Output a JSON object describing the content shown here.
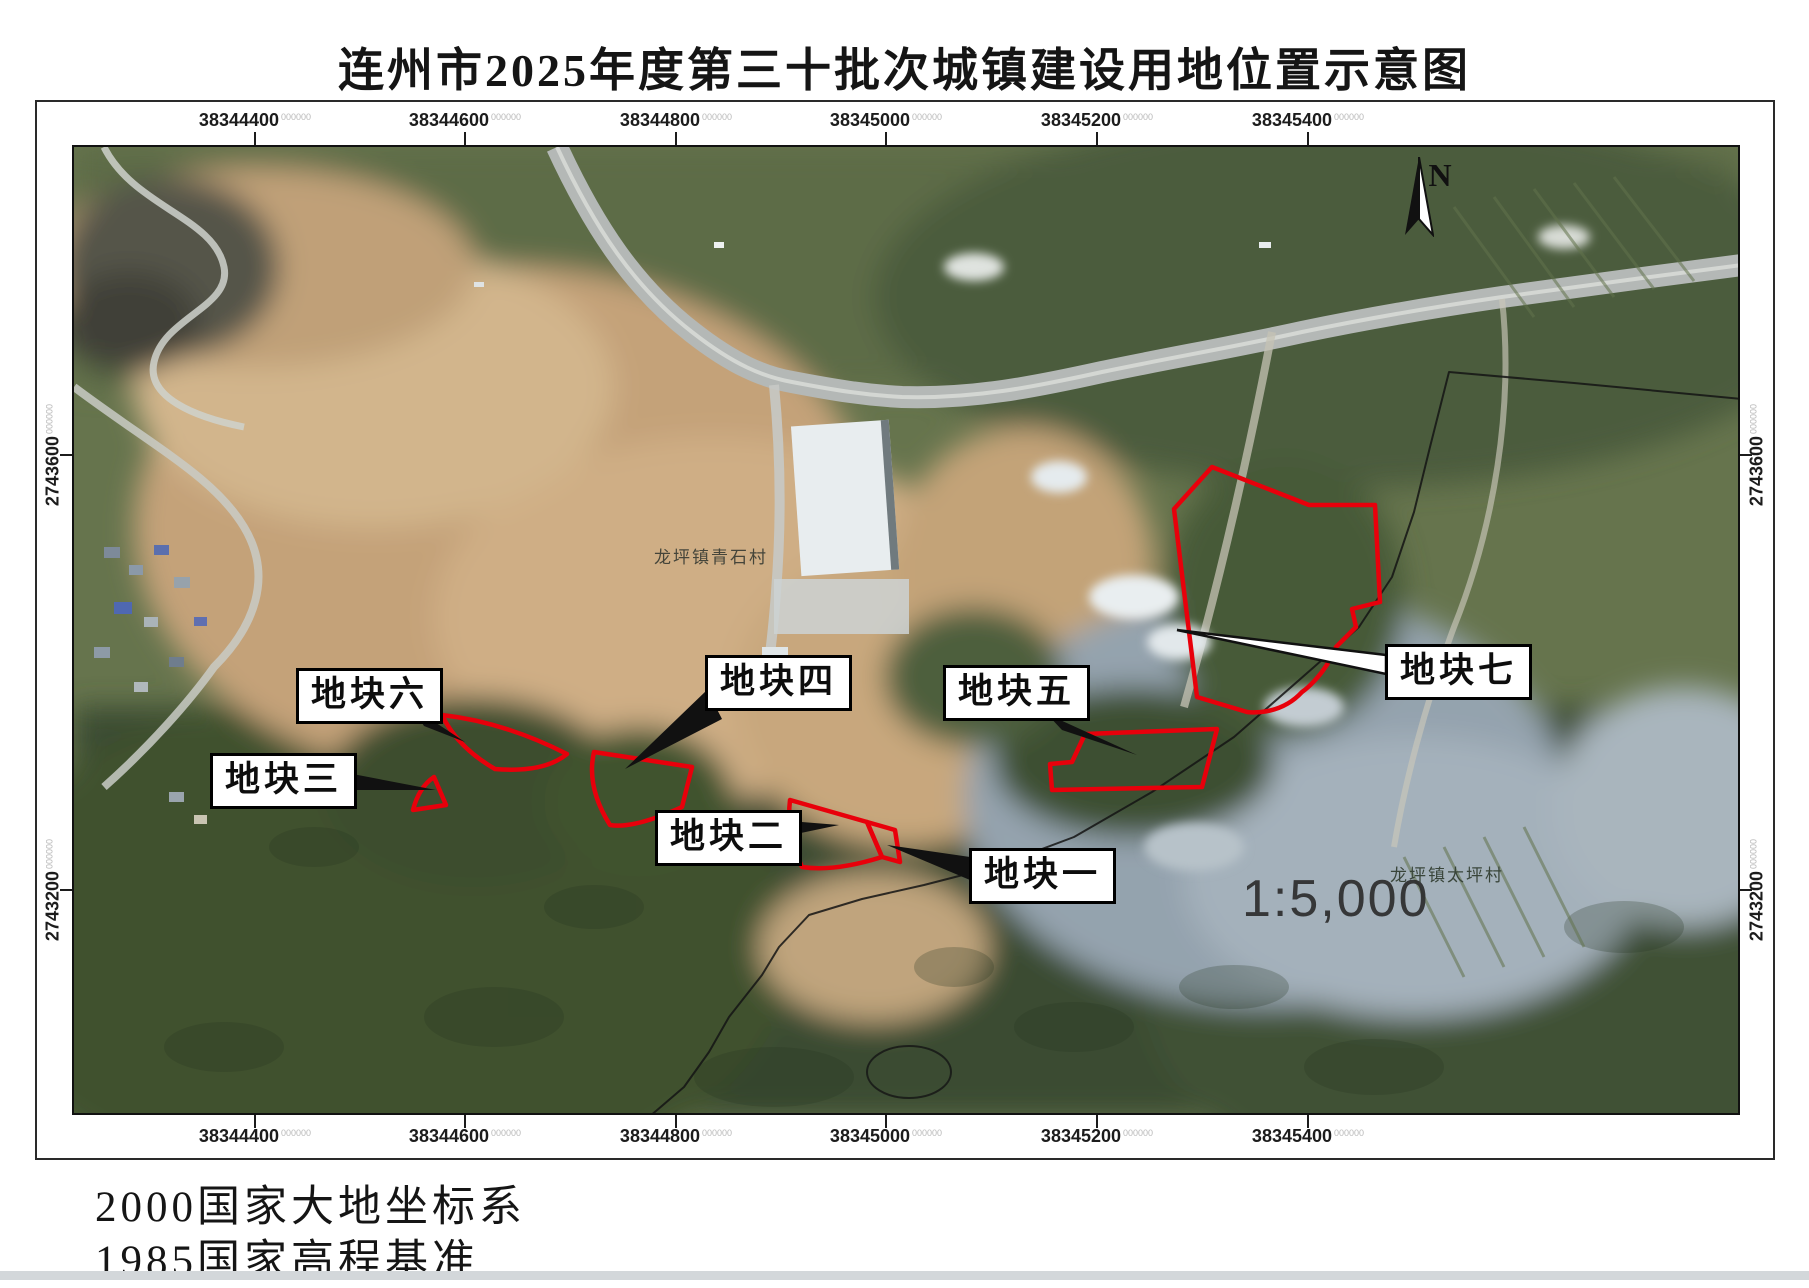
{
  "title": "连州市2025年度第三十批次城镇建设用地位置示意图",
  "north_label": "N",
  "scale_text": "1:5,000",
  "coordinates": {
    "superscript": "000000",
    "top": [
      "38344400",
      "38344600",
      "38344800",
      "38345000",
      "38345200",
      "38345400"
    ],
    "bottom": [
      "38344400",
      "38344600",
      "38344800",
      "38345000",
      "38345200",
      "38345400"
    ],
    "left": [
      "2743600",
      "2743200"
    ],
    "right": [
      "2743600",
      "2743200"
    ]
  },
  "callouts": [
    {
      "label": "地块一"
    },
    {
      "label": "地块二"
    },
    {
      "label": "地块三"
    },
    {
      "label": "地块四"
    },
    {
      "label": "地块五"
    },
    {
      "label": "地块六"
    },
    {
      "label": "地块七"
    }
  ],
  "place_names": {
    "village1": "龙坪镇青石村",
    "village2": "龙坪镇太坪村"
  },
  "footer": {
    "line1": "2000国家大地坐标系",
    "line2": "1985国家高程基准"
  },
  "colors": {
    "parcel_outline": "#e8000b",
    "boundary_line": "#141414",
    "label_box_border": "#000000"
  }
}
